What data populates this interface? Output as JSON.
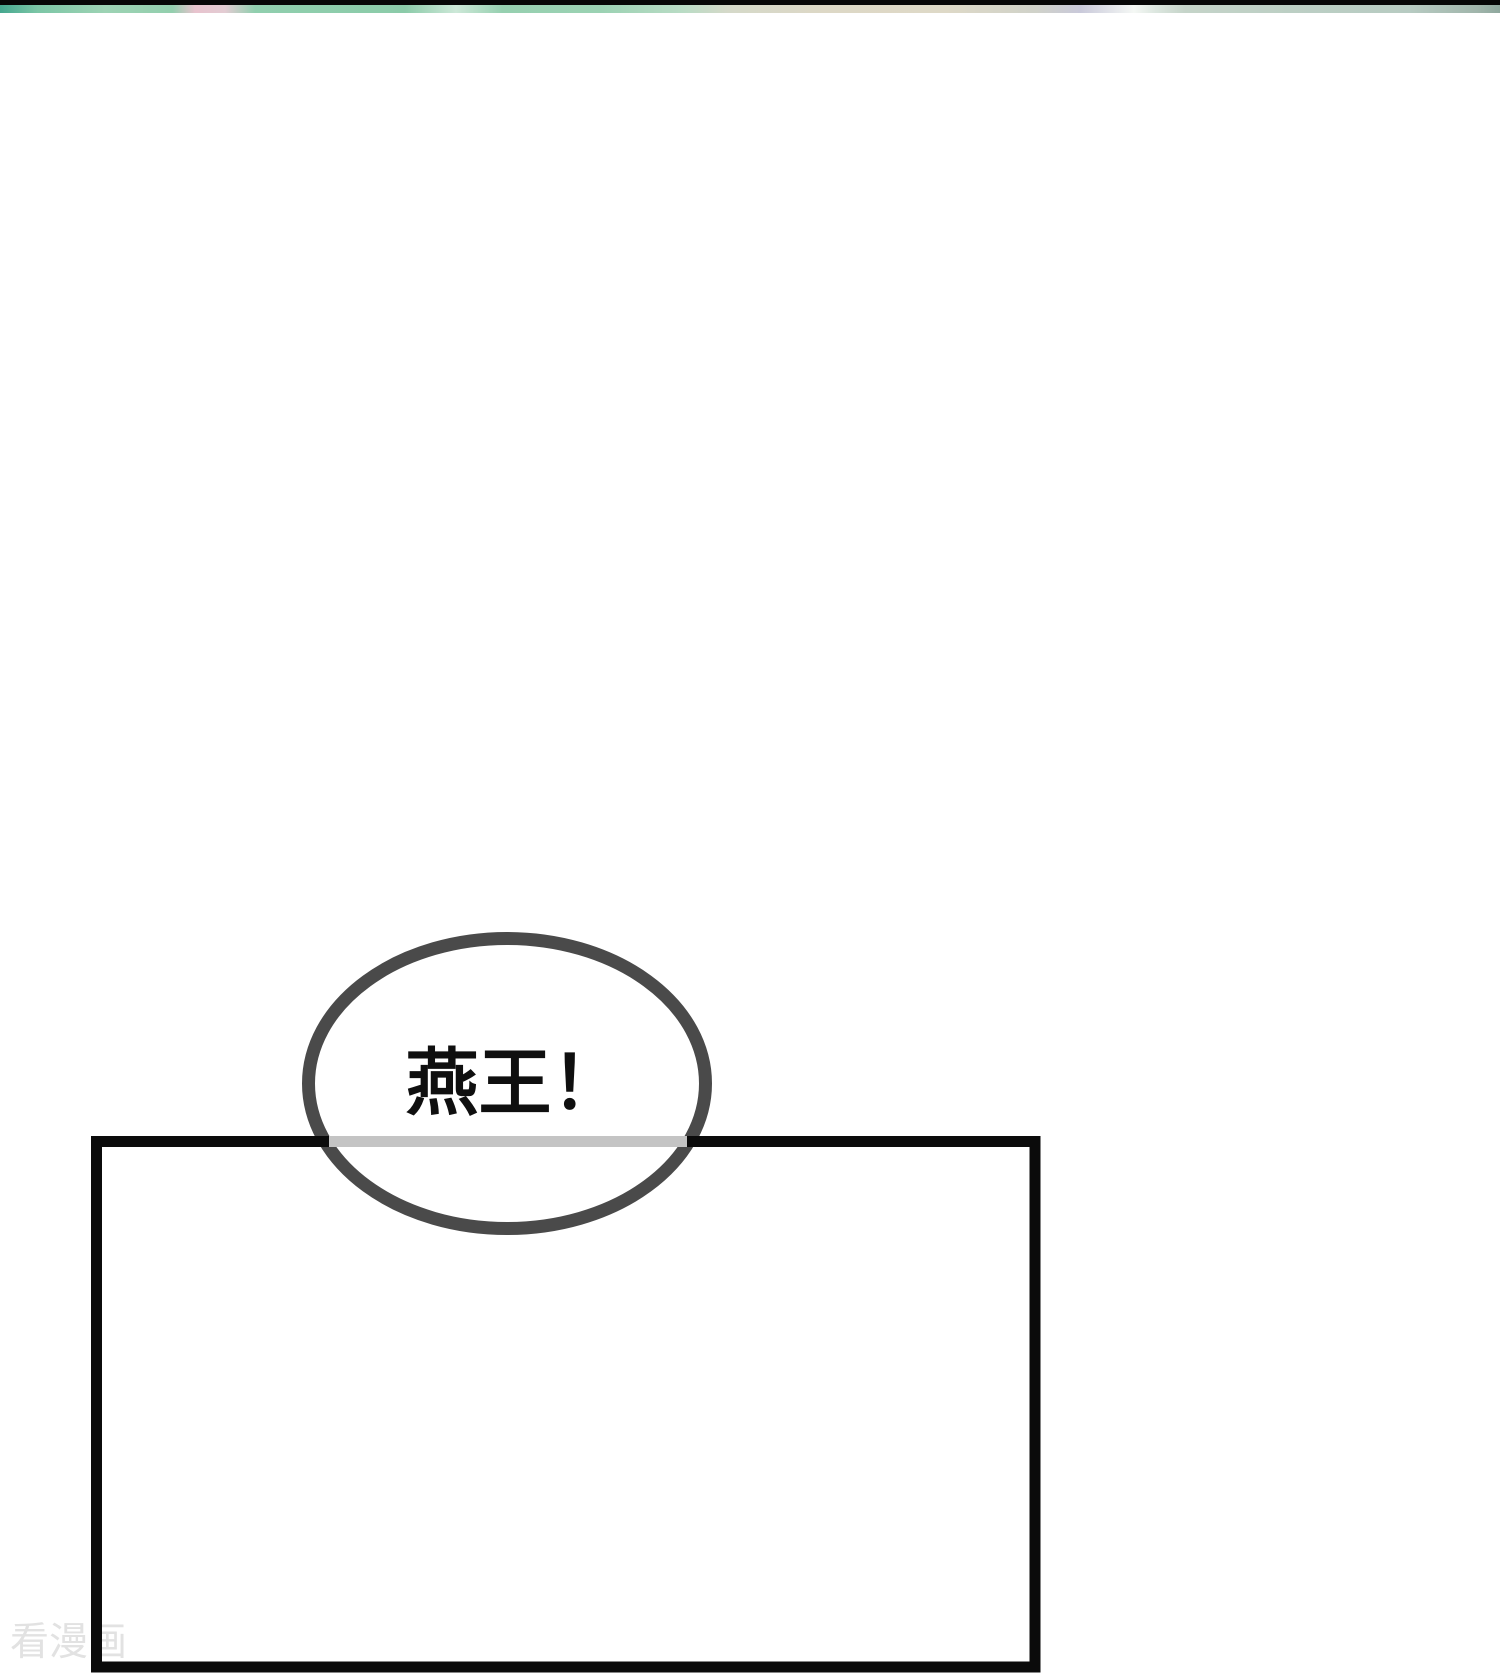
{
  "page": {
    "background": "#ffffff"
  },
  "top_strip": {
    "bar_color": "#070707",
    "art_colors": [
      "#45a78f",
      "#9dd3b4",
      "#e8c3ce",
      "#8bcba9",
      "#ddd8c6",
      "#c9c9da",
      "#f5f8f5",
      "#b7cbc2",
      "#8fa89e"
    ]
  },
  "speech_bubble": {
    "text": "燕王！",
    "text_color": "#0f0f0f",
    "fill_color": "#ffffff",
    "stroke_color": "#4a4a4a"
  },
  "panel": {
    "border_color": "#0b0b0b",
    "overlap_line_color": "#c4c4c4"
  },
  "watermark": {
    "text": "看漫画",
    "color": "#e2e2e2"
  }
}
